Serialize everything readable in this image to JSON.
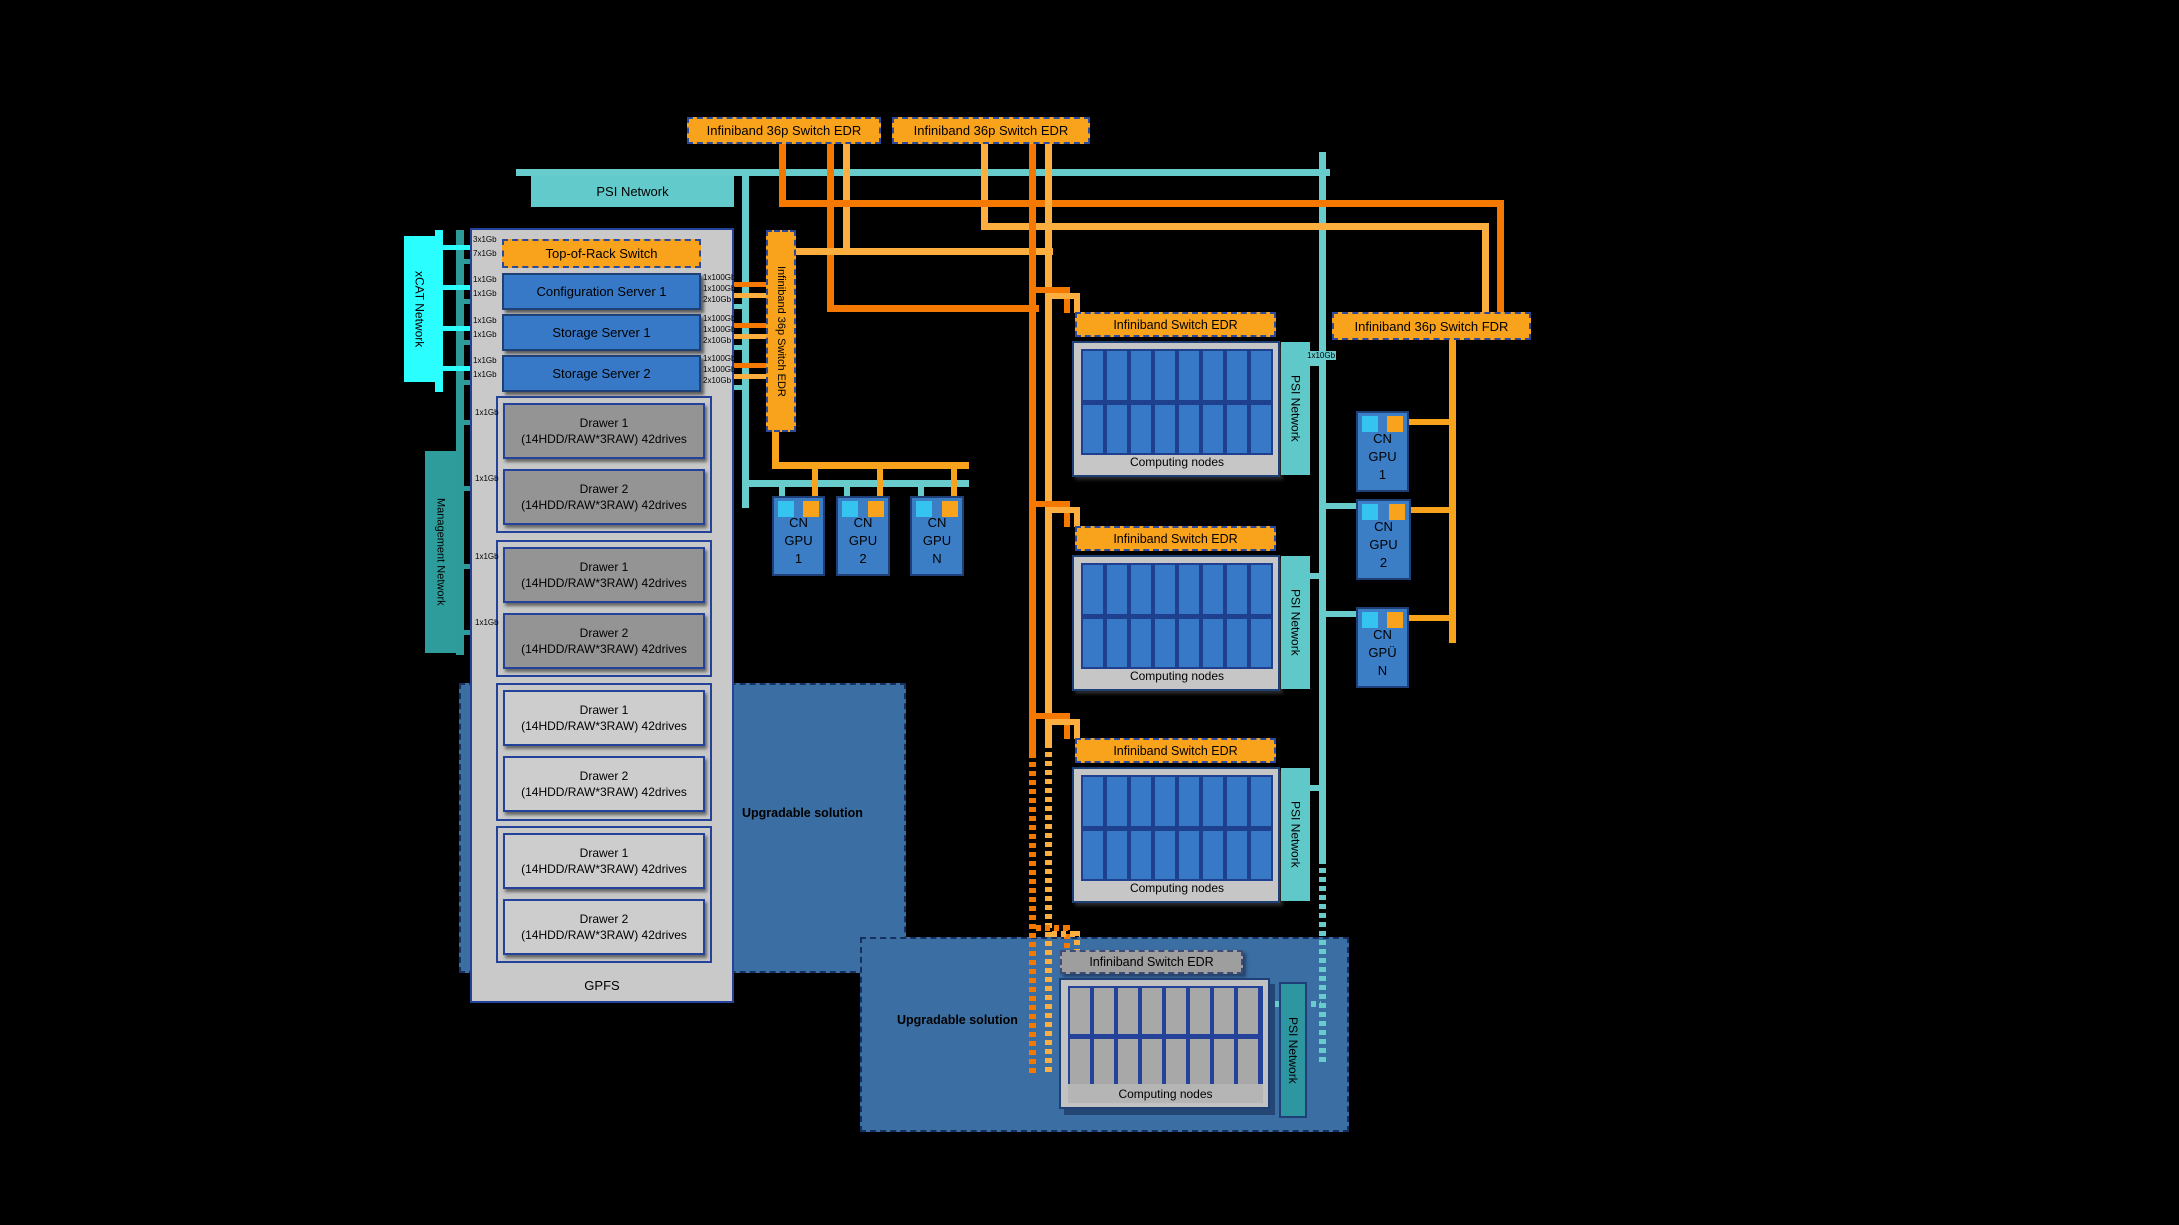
{
  "diagram": {
    "top_switch_1": "Infiniband 36p Switch EDR",
    "top_switch_2": "Infiniband 36p Switch EDR",
    "psi_network_label": "PSI Network",
    "xcat_label": "xCAT Network",
    "management_label": "Management Network",
    "vertical_switch_label": "Infiniband 36p Switch EDR",
    "fdr_switch_label": "Infiniband 36p Switch FDR",
    "gpfs_label": "GPFS",
    "upgradable_label_1": "Upgradable solution",
    "upgradable_label_2": "Upgradable solution",
    "psi_stub_label": "1x10Gb",
    "top_of_rack": {
      "label": "Top-of-Rack Switch",
      "ports_left": [
        "3x1Gb",
        "7x1Gb"
      ]
    },
    "servers": [
      {
        "label": "Configuration Server 1",
        "ports_left": [
          "1x1Gb",
          "1x1Gb"
        ],
        "ports_right": [
          "1x100Gb",
          "1x100Gb",
          "2x10Gb"
        ]
      },
      {
        "label": "Storage Server 1",
        "ports_left": [
          "1x1Gb",
          "1x1Gb"
        ],
        "ports_right": [
          "1x100Gb",
          "1x100Gb",
          "2x10Gb"
        ]
      },
      {
        "label": "Storage Server 2",
        "ports_left": [
          "1x1Gb",
          "1x1Gb"
        ],
        "ports_right": [
          "1x100Gb",
          "1x100Gb",
          "2x10Gb"
        ]
      }
    ],
    "drawer_ports": [
      "1x1Gb",
      "1x1Gb",
      "1x1Gb",
      "1x1Gb"
    ],
    "drawers": [
      {
        "title": "Drawer 1",
        "subtitle": "(14HDD/RAW*3RAW) 42drives"
      },
      {
        "title": "Drawer 2",
        "subtitle": "(14HDD/RAW*3RAW) 42drives"
      },
      {
        "title": "Drawer 1",
        "subtitle": "(14HDD/RAW*3RAW) 42drives"
      },
      {
        "title": "Drawer 2",
        "subtitle": "(14HDD/RAW*3RAW) 42drives"
      },
      {
        "title": "Drawer 1",
        "subtitle": "(14HDD/RAW*3RAW) 42drives"
      },
      {
        "title": "Drawer 2",
        "subtitle": "(14HDD/RAW*3RAW) 42drives"
      },
      {
        "title": "Drawer 1",
        "subtitle": "(14HDD/RAW*3RAW) 42drives"
      },
      {
        "title": "Drawer 2",
        "subtitle": "(14HDD/RAW*3RAW) 42drives"
      }
    ],
    "compute_blocks": [
      {
        "header": "Infiniband Switch EDR",
        "nodes_label": "Computing nodes",
        "psi_label": "PSI Network"
      },
      {
        "header": "Infiniband Switch EDR",
        "nodes_label": "Computing nodes",
        "psi_label": "PSI Network"
      },
      {
        "header": "Infiniband Switch EDR",
        "nodes_label": "Computing nodes",
        "psi_label": "PSI Network"
      },
      {
        "header": "Infiniband Switch EDR",
        "nodes_label": "Computing nodes",
        "psi_label": "PSI Network"
      }
    ],
    "gpus_left": [
      [
        "CN",
        "GPU",
        "1"
      ],
      [
        "CN",
        "GPU",
        "2"
      ],
      [
        "CN",
        "GPU",
        "N"
      ]
    ],
    "gpus_right": [
      [
        "CN",
        "GPU",
        "1"
      ],
      [
        "CN",
        "GPU",
        "2"
      ],
      [
        "CN",
        "GPÜ",
        "N"
      ]
    ],
    "colors": {
      "orange": "#F9A21B",
      "orange_dark_wire": "#F57900",
      "orange_light_wire": "#FCAF3E",
      "teal": "#68CCCC",
      "teal_dark": "#2E9B9B",
      "cyan": "#2AFEFE",
      "blue": "#3779C6",
      "navy": "#24429A",
      "steel_blue": "#3B6EA2"
    }
  }
}
